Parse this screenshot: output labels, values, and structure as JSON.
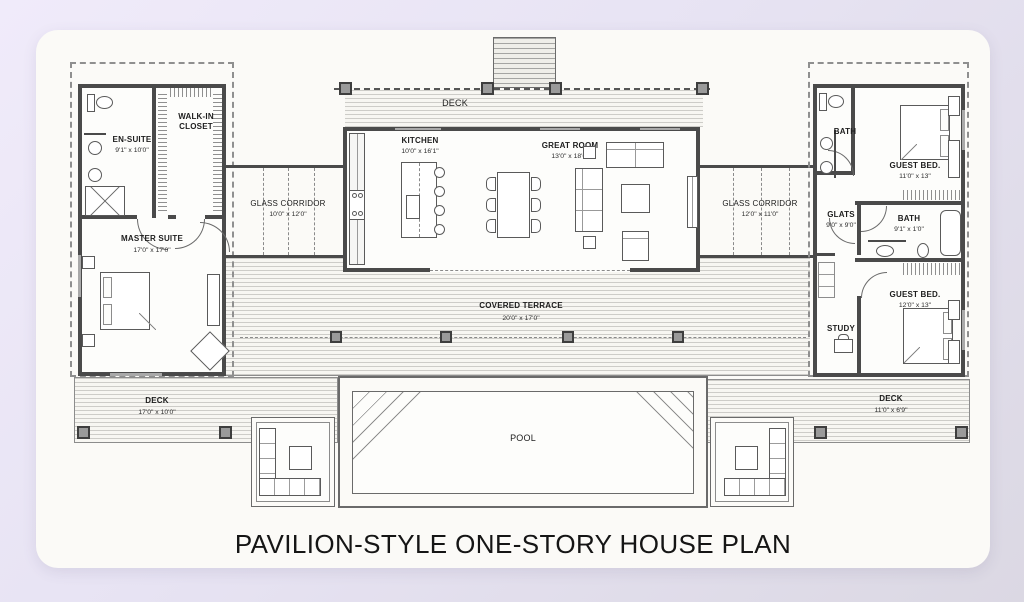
{
  "page": {
    "title": "PAVILION-STYLE ONE-STORY HOUSE PLAN"
  },
  "colors": {
    "background": "#e9e4f5",
    "card": "#fbfaf7",
    "wall": "#4a4a4a",
    "hatch_line": "#cdccc8",
    "post": "#9a9a9a",
    "text": "#1d1d1d"
  },
  "rooms": {
    "deck_top": {
      "name": "DECK"
    },
    "kitchen": {
      "name": "KITCHEN",
      "dims": "10'0\" x 16'1\""
    },
    "great_room": {
      "name": "GREAT ROOM",
      "dims": "13'0\" x 18'0\""
    },
    "en_suite": {
      "name": "EN-SUITE",
      "dims": "9'1\" x 10'0\""
    },
    "walk_in_closet": {
      "name": "WALK-IN CLOSET"
    },
    "master_suite": {
      "name": "MASTER SUITE",
      "dims": "17'0\" x 17'0\""
    },
    "glass_corridor_left": {
      "name": "GLASS CORRIDOR",
      "dims": "10'0\" x 12'0\""
    },
    "glass_corridor_right": {
      "name": "GLASS CORRIDOR",
      "dims": "12'0\" x 11'0\""
    },
    "bath_guest_top": {
      "name": "BATH"
    },
    "guest_bed_top": {
      "name": "GUEST BED.",
      "dims": "11'0\" x 13\""
    },
    "glats": {
      "name": "GLATS",
      "dims": "9'0\" x 9'0\""
    },
    "bath_guest_mid": {
      "name": "BATH",
      "dims": "9'1\" x 1'0\""
    },
    "study": {
      "name": "STUDY"
    },
    "guest_bed_bottom": {
      "name": "GUEST BED.",
      "dims": "12'0\" x 13\""
    },
    "covered_terrace": {
      "name": "COVERED TERRACE",
      "dims": "20'0\" x 17'0\""
    },
    "deck_left": {
      "name": "DECK",
      "dims": "17'0\" x 10'0\""
    },
    "deck_right": {
      "name": "DECK",
      "dims": "11'0\" x 6'9\""
    },
    "pool": {
      "name": "POOL"
    }
  }
}
